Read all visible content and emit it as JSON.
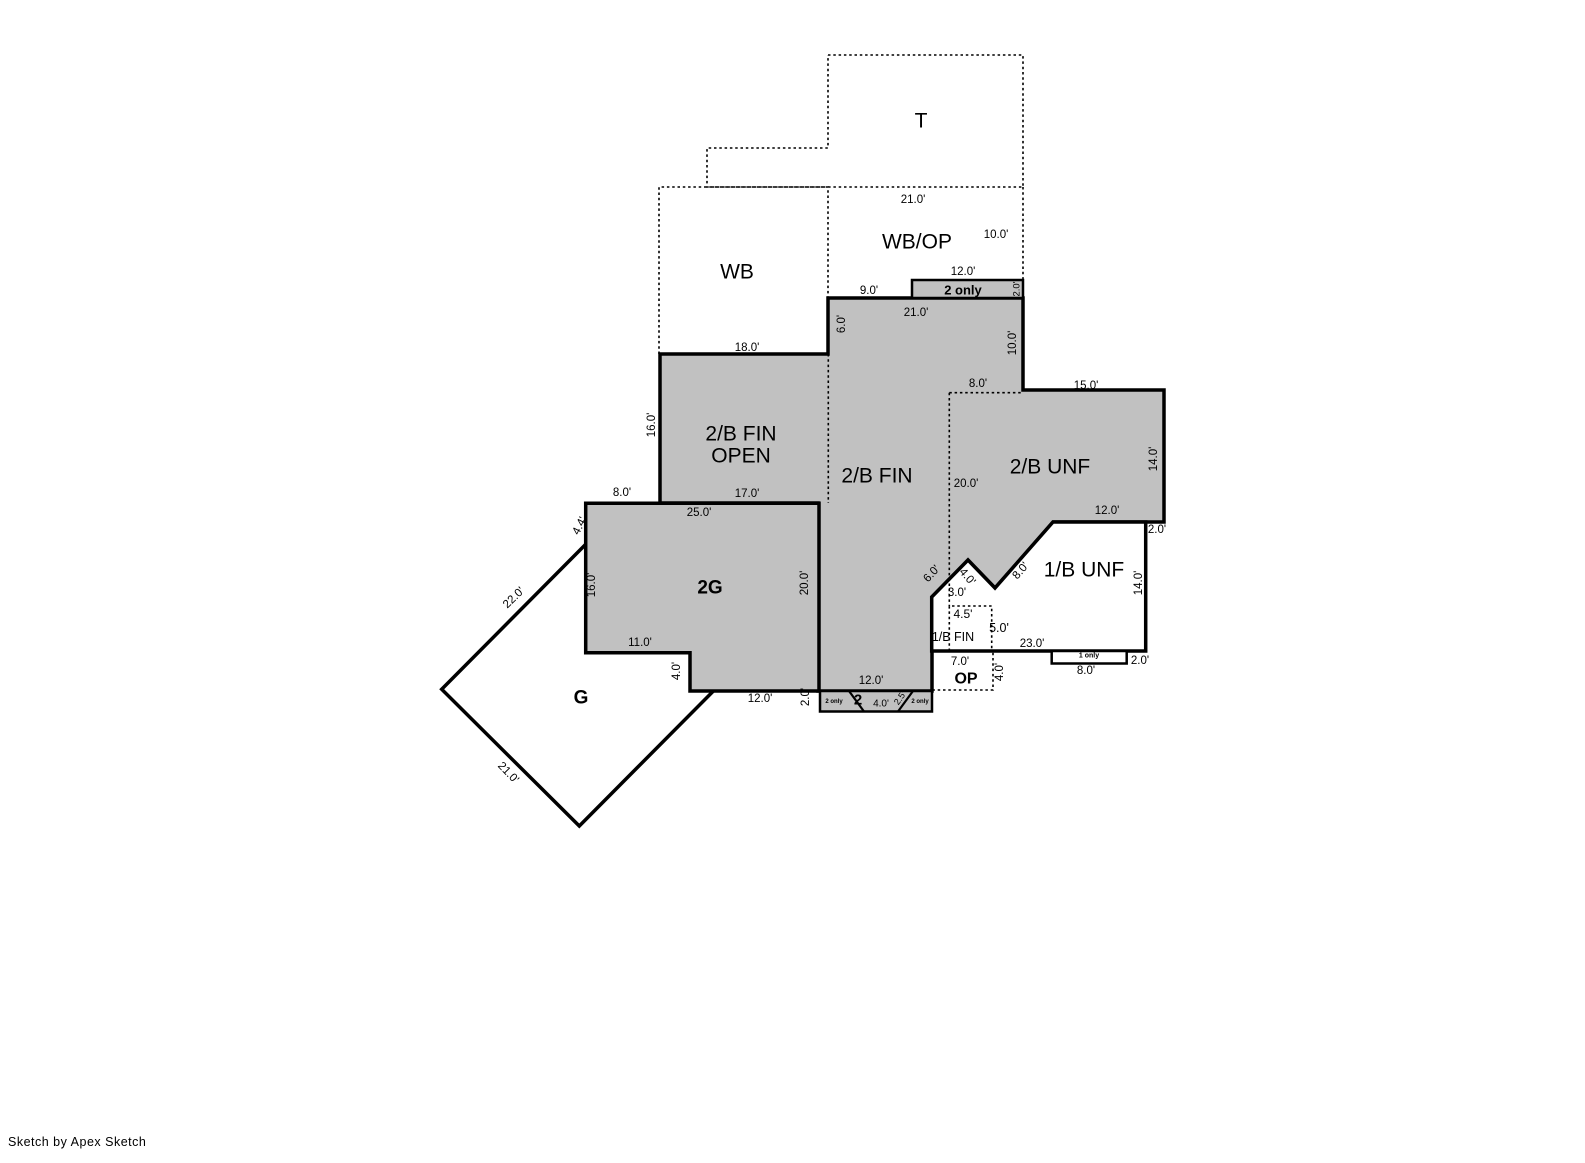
{
  "canvas": {
    "width": 1585,
    "height": 1163,
    "background": "#ffffff",
    "wall_color": "#000000",
    "finished_fill": "#c1c1c1",
    "unshaded_fill": "#ffffff"
  },
  "footer": {
    "credit": "Sketch by Apex Sketch"
  },
  "areas_legend": [
    "T",
    "WB",
    "WB/OP",
    "2/B FIN OPEN",
    "2/B FIN",
    "2/B UNF",
    "1/B UNF",
    "2G",
    "G",
    "OP",
    "1/B FIN"
  ],
  "floorplan": {
    "polygons": [
      {
        "name": "garage-g-diamond",
        "points": "584,546 441.7,689.3 579.3,826 721.6,682.7",
        "fill": "#ffffff",
        "sw": 3.5
      },
      {
        "name": "upper-finished-area",
        "points": "660,354 828,354 828,298 1023,298 1023,390 1164,390 1164,522 1053,522 995,588 968,560 932,597 932,691 818,691 818,503 660,503",
        "fill": "#c1c1c1",
        "sw": 3.5
      },
      {
        "name": "strip-2only-upper",
        "points": "912,280 1023,280 1023,298 912,298",
        "fill": "#c1c1c1",
        "sw": 2.5
      },
      {
        "name": "garage-2g",
        "points": "585.7,503.3 819,503.3 819,691 690,691 690,652.7 585.7,652.7",
        "fill": "#c1c1c1",
        "sw": 3.5
      },
      {
        "name": "basement-1b-unf",
        "points": "1053,522 1145.7,522 1145.7,651 931.7,651 931.7,597 968,560 995,588",
        "fill": "#ffffff",
        "sw": 3.5
      },
      {
        "name": "strip-2-bottom",
        "points": "820,691 932,691 932,711.5 820,711.5",
        "fill": "#c1c1c1",
        "sw": 2.5
      },
      {
        "name": "strip-1only",
        "points": "1051.7,651 1126.7,651 1126.7,663.5 1051.7,663.5",
        "fill": "#ffffff",
        "sw": 2.5
      }
    ],
    "lines": [
      {
        "name": "attic-t-outline",
        "points": "828,55 1023,55 1023,187 707,187 707,148 828,148 828,55",
        "dash": true
      },
      {
        "name": "wb-outline",
        "points": "659,354 659,187 828,187 828,298",
        "dash": true
      },
      {
        "name": "wbop-right-edge",
        "points": "1023,187 1023,280",
        "dash": true
      },
      {
        "name": "divider-open-fin",
        "points": "828.3,354 828.3,503",
        "dash": true
      },
      {
        "name": "divider-fin-unf-vertical",
        "points": "949.3,392.7 949.3,606",
        "dash": true
      },
      {
        "name": "divider-fin-unf-horizontal",
        "points": "949.3,392.7 1022.7,392.7",
        "dash": true
      },
      {
        "name": "basement-1bfin-box",
        "points": "949.3,651 949.3,606 991.7,606 991.7,651",
        "dash": true
      },
      {
        "name": "porch-op-outline",
        "points": "993,652.7 993,690 931.7,690",
        "dash": true
      },
      {
        "name": "strip-diagonal-left",
        "points": "849,691 864,711.5",
        "dash": false,
        "sw": 2.2
      },
      {
        "name": "strip-diagonal-right",
        "points": "898,711.5 913,691",
        "dash": false,
        "sw": 2.2
      }
    ],
    "labels": [
      {
        "name": "area-t",
        "text": "T",
        "x": 921,
        "y": 121,
        "s": 21
      },
      {
        "name": "area-wb",
        "text": "WB",
        "x": 737,
        "y": 272,
        "s": 21
      },
      {
        "name": "area-wbop",
        "text": "WB/OP",
        "x": 917,
        "y": 242,
        "s": 21
      },
      {
        "name": "area-2bfin-open-line1",
        "text": "2/B FIN",
        "x": 741,
        "y": 434,
        "s": 21
      },
      {
        "name": "area-2bfin-open-line2",
        "text": "OPEN",
        "x": 741,
        "y": 456,
        "s": 21
      },
      {
        "name": "area-2bfin",
        "text": "2/B FIN",
        "x": 877,
        "y": 476,
        "s": 21
      },
      {
        "name": "area-2bunf",
        "text": "2/B UNF",
        "x": 1050,
        "y": 467,
        "s": 21
      },
      {
        "name": "area-1bunf",
        "text": "1/B UNF",
        "x": 1084,
        "y": 570,
        "s": 21
      },
      {
        "name": "area-2g",
        "text": "2G",
        "x": 710,
        "y": 588,
        "s": 19,
        "w": 700
      },
      {
        "name": "area-g",
        "text": "G",
        "x": 581,
        "y": 698,
        "s": 19,
        "w": 700
      },
      {
        "name": "area-op",
        "text": "OP",
        "x": 966,
        "y": 679,
        "s": 16,
        "w": 700
      },
      {
        "name": "area-1bfin",
        "text": "1/B FIN",
        "x": 953,
        "y": 637,
        "s": 12.5
      },
      {
        "name": "badge-2only-upper",
        "text": "2 only",
        "x": 963,
        "y": 290,
        "s": 13,
        "w": 700
      },
      {
        "name": "badge-2only-strip-left",
        "text": "2 only",
        "x": 834,
        "y": 702,
        "s": 6,
        "w": 700
      },
      {
        "name": "badge-2only-strip-right",
        "text": "2 only",
        "x": 920,
        "y": 702,
        "s": 6,
        "w": 700
      },
      {
        "name": "badge-2-strip",
        "text": "2",
        "x": 858,
        "y": 700,
        "s": 15,
        "w": 700
      },
      {
        "name": "badge-1only-strip",
        "text": "1 only",
        "x": 1089,
        "y": 656,
        "s": 7,
        "w": 700
      },
      {
        "name": "dim-wbop-top",
        "text": "21.0'",
        "x": 913,
        "y": 200,
        "s": 11.5
      },
      {
        "name": "dim-wbop-right",
        "text": "10.0'",
        "x": 996,
        "y": 235,
        "s": 11.5
      },
      {
        "name": "dim-2only-upper-width",
        "text": "12.0'",
        "x": 963,
        "y": 272,
        "s": 11.5
      },
      {
        "name": "dim-2only-upper-height",
        "text": "2.0'",
        "x": 1017,
        "y": 289,
        "s": 9.5,
        "r": -90
      },
      {
        "name": "dim-fin-top-left",
        "text": "9.0'",
        "x": 869,
        "y": 291,
        "s": 11.5
      },
      {
        "name": "dim-fin-top",
        "text": "21.0'",
        "x": 916,
        "y": 313,
        "s": 11.5
      },
      {
        "name": "dim-fin-left-upper",
        "text": "6.0'",
        "x": 842,
        "y": 324,
        "s": 11.5,
        "r": -90
      },
      {
        "name": "dim-fin-right-upper",
        "text": "10.0'",
        "x": 1013,
        "y": 343,
        "s": 11.5,
        "r": -90
      },
      {
        "name": "dim-open-top",
        "text": "18.0'",
        "x": 747,
        "y": 348,
        "s": 11.5
      },
      {
        "name": "dim-unf-dotted-top",
        "text": "8.0'",
        "x": 978,
        "y": 384,
        "s": 11.5
      },
      {
        "name": "dim-2bunf-top",
        "text": "15.0'",
        "x": 1086,
        "y": 386,
        "s": 11.5
      },
      {
        "name": "dim-open-left",
        "text": "16.0'",
        "x": 652,
        "y": 425,
        "s": 11.5,
        "r": -90
      },
      {
        "name": "dim-fin-unf-divider",
        "text": "20.0'",
        "x": 966,
        "y": 484,
        "s": 11.5
      },
      {
        "name": "dim-2bunf-right",
        "text": "14.0'",
        "x": 1154,
        "y": 459,
        "s": 11.5,
        "r": -90
      },
      {
        "name": "dim-2g-top-left",
        "text": "8.0'",
        "x": 622,
        "y": 493,
        "s": 11.5
      },
      {
        "name": "dim-open-bottom",
        "text": "17.0'",
        "x": 747,
        "y": 494,
        "s": 11.5
      },
      {
        "name": "dim-2g-top",
        "text": "25.0'",
        "x": 699,
        "y": 513,
        "s": 11.5
      },
      {
        "name": "dim-2bunf-bottom",
        "text": "12.0'",
        "x": 1107,
        "y": 511,
        "s": 11.5
      },
      {
        "name": "dim-2bunf-inset",
        "text": "2.0'",
        "x": 1157,
        "y": 530,
        "s": 11.5
      },
      {
        "name": "dim-2g-left-upper",
        "text": "4.4'",
        "x": 580,
        "y": 526,
        "s": 11.5,
        "r": -63
      },
      {
        "name": "dim-g-upper-left",
        "text": "22.0'",
        "x": 514,
        "y": 598,
        "s": 11.5,
        "r": -44
      },
      {
        "name": "dim-2g-left",
        "text": "16.0'",
        "x": 592,
        "y": 585,
        "s": 11.5,
        "r": -90
      },
      {
        "name": "dim-fin-left-lower",
        "text": "20.0'",
        "x": 805,
        "y": 583,
        "s": 11.5,
        "r": -90
      },
      {
        "name": "dim-zigzag-6ft",
        "text": "6.0'",
        "x": 932,
        "y": 574,
        "s": 11.5,
        "r": -47
      },
      {
        "name": "dim-zigzag-4ft",
        "text": "4.0'",
        "x": 967,
        "y": 577,
        "s": 11.5,
        "r": 49
      },
      {
        "name": "dim-zigzag-3ft",
        "text": "3.0'",
        "x": 957,
        "y": 593,
        "s": 11.5
      },
      {
        "name": "dim-zigzag-8ft",
        "text": "8.0'",
        "x": 1021,
        "y": 571,
        "s": 11.5,
        "r": -49
      },
      {
        "name": "dim-1bunf-right",
        "text": "14.0'",
        "x": 1139,
        "y": 583,
        "s": 11.5,
        "r": -90
      },
      {
        "name": "dim-1bfin-width",
        "text": "4.5'",
        "x": 963,
        "y": 614,
        "s": 12
      },
      {
        "name": "dim-1bfin-height",
        "text": "5.0'",
        "x": 999,
        "y": 628,
        "s": 12.5
      },
      {
        "name": "dim-1bunf-bottom",
        "text": "23.0'",
        "x": 1032,
        "y": 644,
        "s": 11.5
      },
      {
        "name": "dim-2g-bottom-left",
        "text": "11.0'",
        "x": 640,
        "y": 643,
        "s": 11.5
      },
      {
        "name": "dim-2g-step",
        "text": "4.0'",
        "x": 677,
        "y": 671,
        "s": 11.5,
        "r": -90
      },
      {
        "name": "dim-op-width",
        "text": "7.0'",
        "x": 960,
        "y": 662,
        "s": 11.5
      },
      {
        "name": "dim-op-height",
        "text": "4.0'",
        "x": 1000,
        "y": 672,
        "s": 11.5,
        "r": -90
      },
      {
        "name": "dim-1only-height",
        "text": "2.0'",
        "x": 1140,
        "y": 661,
        "s": 11.5
      },
      {
        "name": "dim-1only-width",
        "text": "8.0'",
        "x": 1086,
        "y": 671,
        "s": 11.5
      },
      {
        "name": "dim-2g-bottom-right",
        "text": "12.0'",
        "x": 760,
        "y": 699,
        "s": 11.5
      },
      {
        "name": "dim-strip-height",
        "text": "2.0'",
        "x": 806,
        "y": 697,
        "s": 11.5,
        "r": -90
      },
      {
        "name": "dim-fin-bottom",
        "text": "12.0'",
        "x": 871,
        "y": 681,
        "s": 11.5
      },
      {
        "name": "dim-strip-4ft",
        "text": "4.0'",
        "x": 881,
        "y": 704,
        "s": 10
      },
      {
        "name": "dim-strip-2-5ft",
        "text": "2.5'",
        "x": 900,
        "y": 698,
        "s": 9,
        "r": -55
      },
      {
        "name": "dim-g-lower-left",
        "text": "21.0'",
        "x": 508,
        "y": 773,
        "s": 11.5,
        "r": 46
      }
    ]
  }
}
